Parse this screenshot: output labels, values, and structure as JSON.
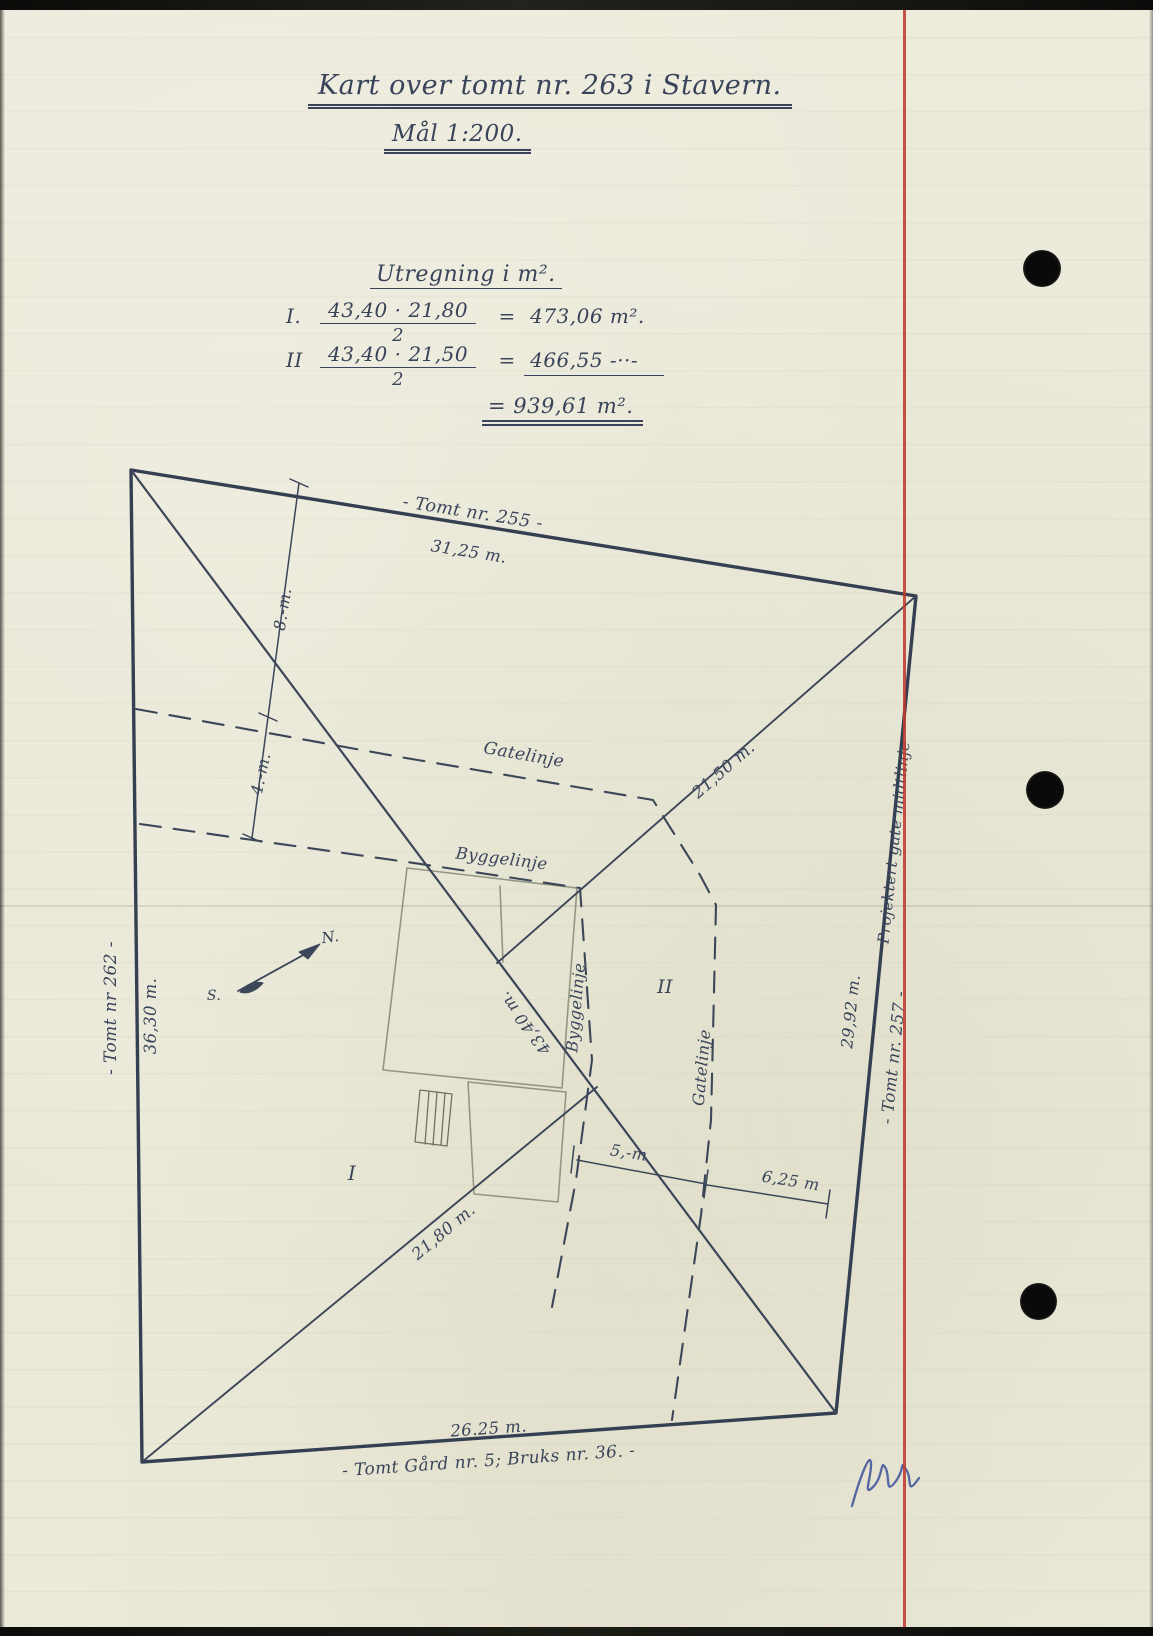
{
  "document": {
    "title": "Kart over tomt nr. 263 i Stavern.",
    "scale": "Mål 1:200."
  },
  "calculation": {
    "heading": "Utregning i m².",
    "rows": [
      {
        "label": "I.",
        "numerator": "43,40 · 21,80",
        "denominator": "2",
        "equals": "=",
        "result": "473,06 m²."
      },
      {
        "label": "II",
        "numerator": "43,40 · 21,50",
        "denominator": "2",
        "equals": "=",
        "result": "466,55 -··-"
      }
    ],
    "total": "= 939,61 m²."
  },
  "map": {
    "boundaries": {
      "north_label": "- Tomt nr. 255 -",
      "north_length": "31,25 m.",
      "west_label": "- Tomt nr 262 -",
      "west_length": "36,30 m.",
      "east_street_label": "Projektert gate midtlinje",
      "east_length": "29,92 m.",
      "east_label": "- Tomt nr. 257 -",
      "south_length": "26.25 m.",
      "south_label": "- Tomt Gård nr. 5; Bruks nr. 36. -"
    },
    "lines": {
      "gatelinje_upper": "Gatelinje",
      "byggelinje_upper": "Byggelinje",
      "byggelinje_east": "Byggelinje",
      "gatelinje_east": "Gatelinje"
    },
    "measurements": {
      "diagonal": "43,40 m.",
      "height_upper": "21,50 m.",
      "height_lower": "21,80 m.",
      "offset_8m": "8.-m.",
      "offset_4m": "4.-m.",
      "offset_5m": "5,-m",
      "offset_625": "6,25 m"
    },
    "regions": {
      "one": "I",
      "two": "II"
    },
    "compass": {
      "north": "N.",
      "south": "S."
    }
  },
  "colors": {
    "paper": "#ebe8d6",
    "ink": "#39445a",
    "pencil": "#8f9180",
    "margin_red": "#bf3a2d",
    "signature_blue": "#45589c",
    "hole_black": "#0a0a0a"
  }
}
